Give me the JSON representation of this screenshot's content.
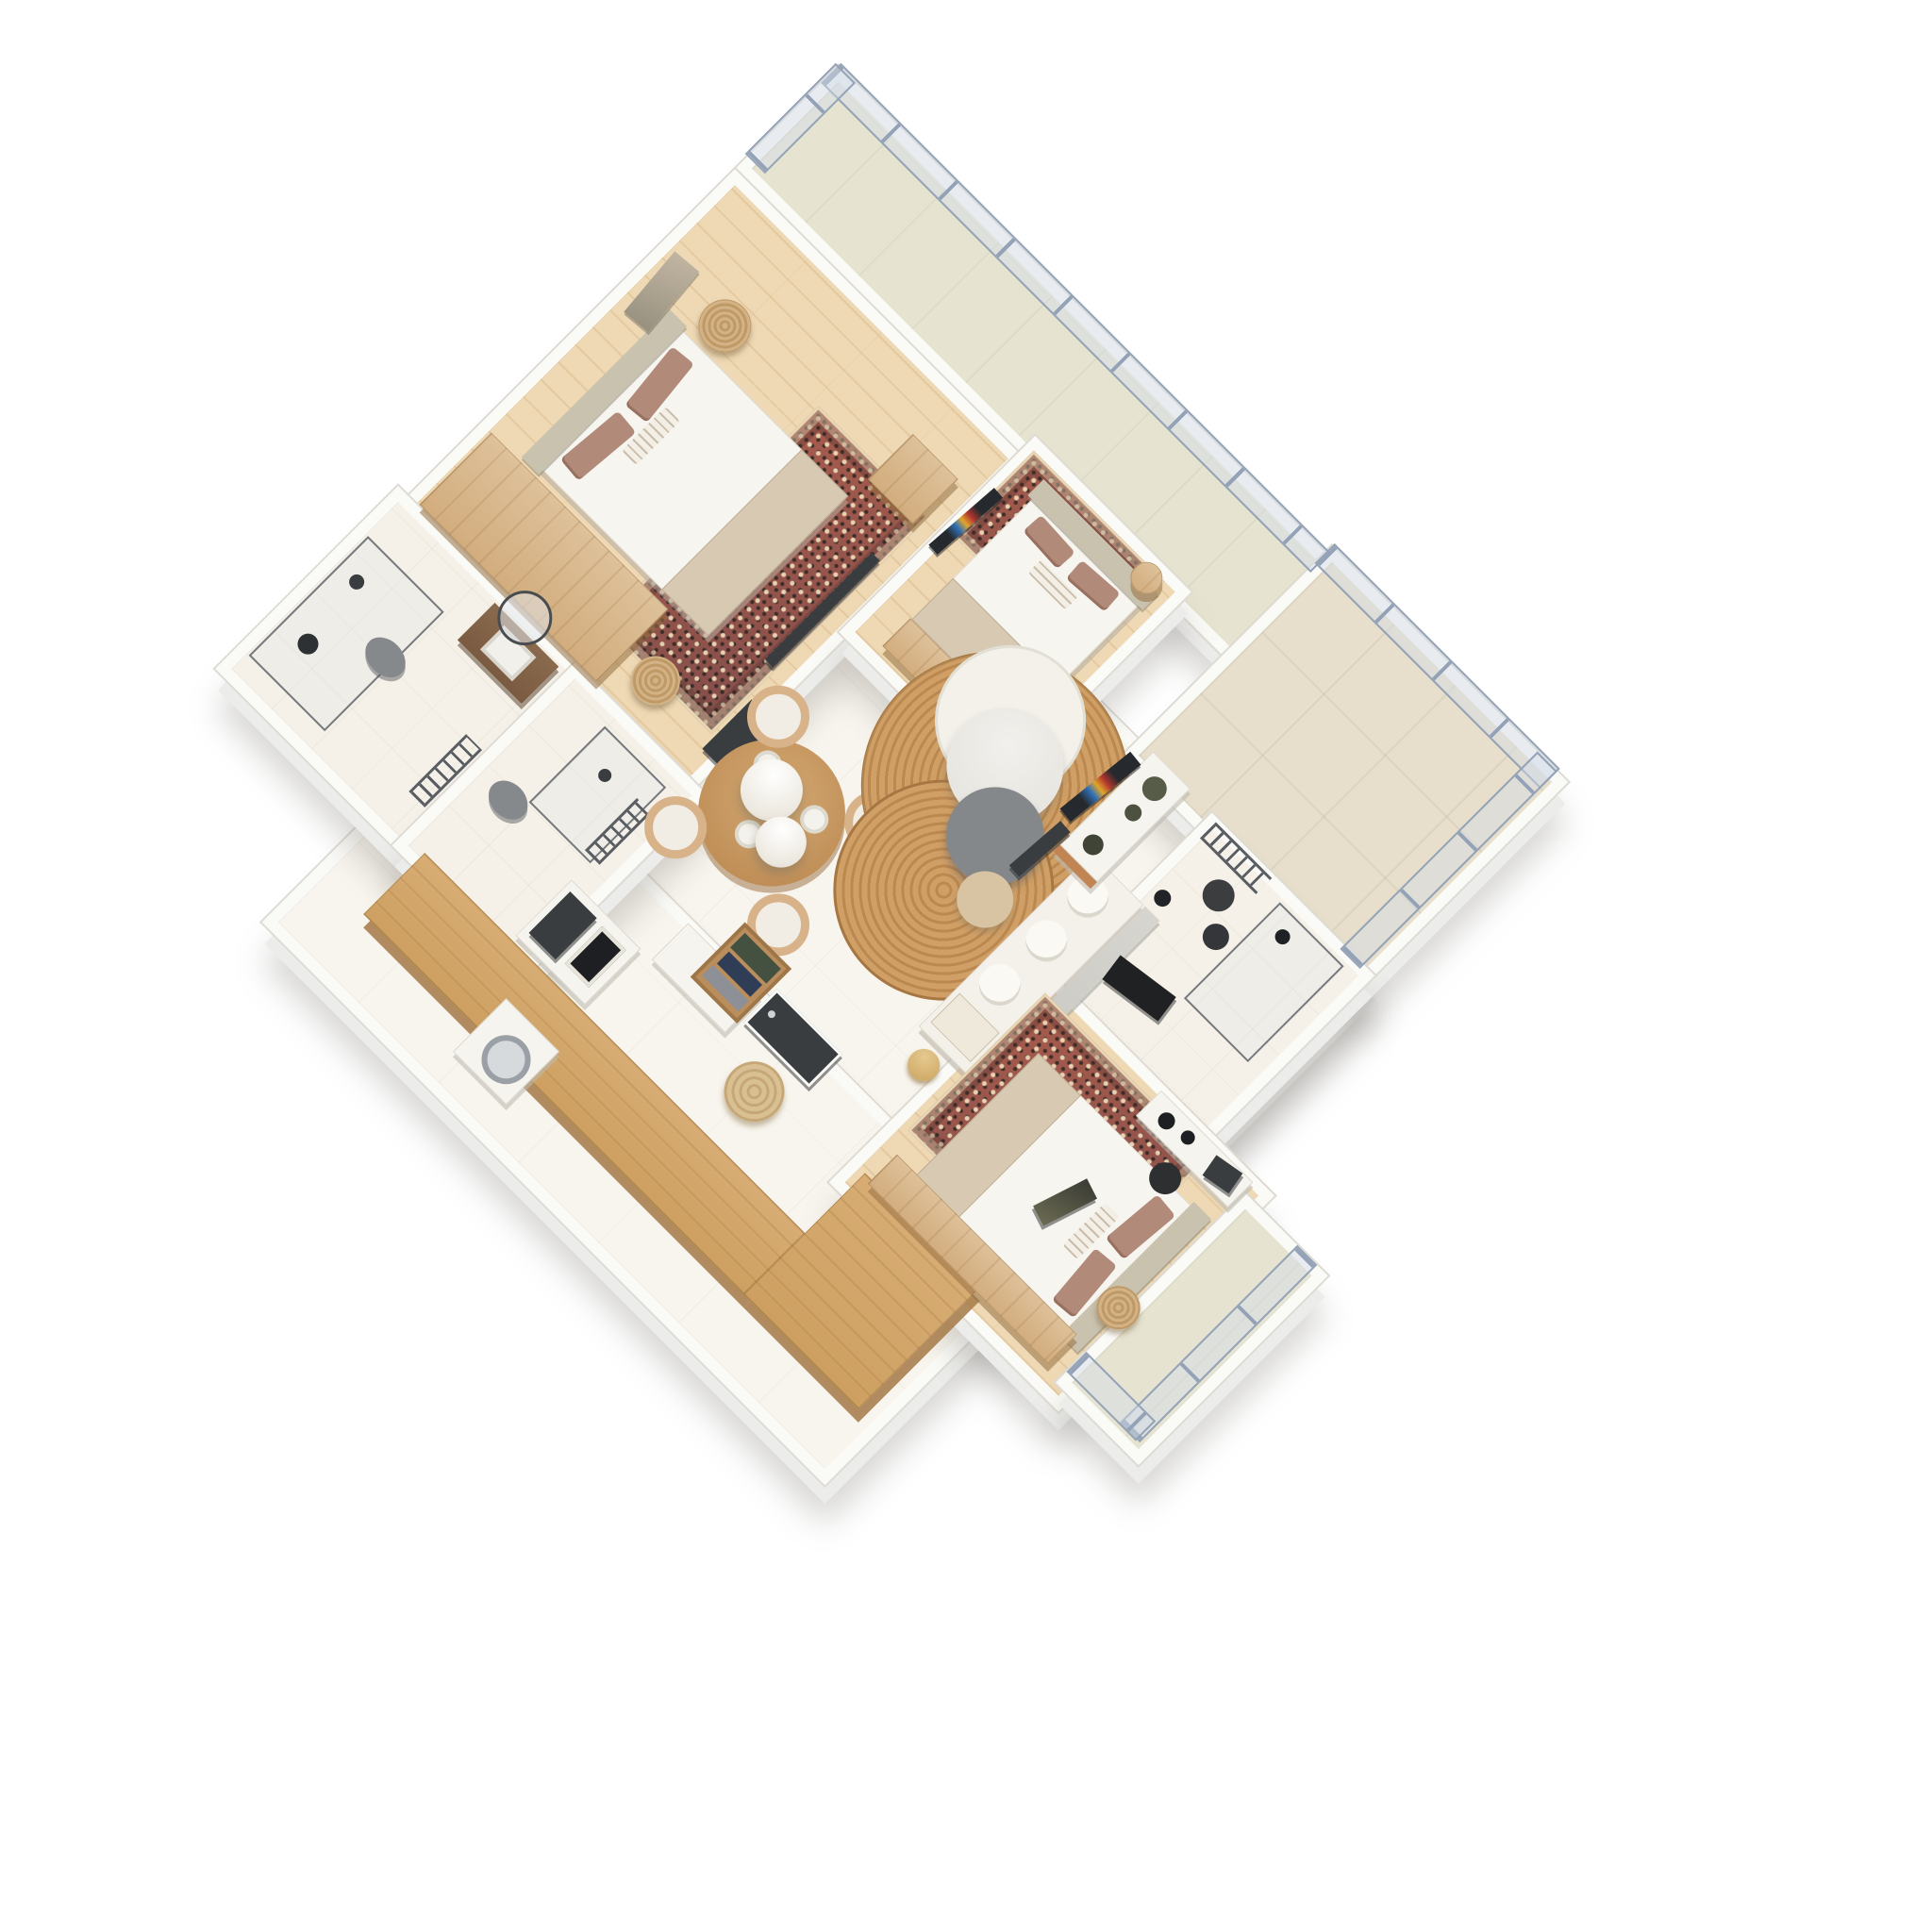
{
  "scene": {
    "type": "isometric-3d-floor-plan-render",
    "view": "top-down rotated 45 degrees",
    "background": "#ffffff",
    "visible_text": "none"
  },
  "palette": {
    "wall": "#fafaf7",
    "wall_edge": "#dedbd4",
    "wood_floor": "#eed9b4",
    "cream_tile_floor": "#f8f5ee",
    "terrace_tile": "#e7decb",
    "balcony_tile": "#e6e3d1",
    "glass_railing": "#c6d0dd",
    "railing_frame": "#93a2b6",
    "counter_wood": "#d2a76f",
    "wardrobe_wood": "#dec19a",
    "ornate_rug_base": "#a05a4a",
    "ornate_rug_accent": "#e7d6b4",
    "jute_rug": "#cf9f66",
    "marble_table": "#edebe7",
    "gray_table": "#84888b",
    "beige_table": "#d8c3a3",
    "sofa": "#f4f1ea",
    "bed_linen": "#f7f5f0",
    "blanket": "#d8c9b2",
    "pillow_mauve": "#b18a79",
    "headboard": "#c9c2ae",
    "dark_fixture": "#3a3d40",
    "toilet_gray": "#85898c",
    "gold_lamp": "#c9a25e",
    "olive_vase": "#575c49",
    "book_green": "#445140",
    "book_navy": "#2f3d57",
    "rattan_pendant": "#d3b285"
  },
  "rooms": [
    {
      "id": 0,
      "name": "north balcony",
      "floor": "balcony tile",
      "furniture": [
        "glass railing",
        "railing posts"
      ]
    },
    {
      "id": 1,
      "name": "east terrace",
      "floor": "large beige tiles",
      "furniture": [
        "glass railing"
      ]
    },
    {
      "id": 2,
      "name": "bedroom 1",
      "floor": "light oak planks",
      "furniture": [
        "double bed",
        "headboard",
        "mauve pillows",
        "striped lumbar pillow",
        "beige blanket",
        "ornate rug",
        "wood wardrobe",
        "nightstand bench",
        "two rattan pendant lamps",
        "wall art",
        "wall tv"
      ]
    },
    {
      "id": 3,
      "name": "bedroom 2",
      "floor": "light oak planks",
      "furniture": [
        "double bed",
        "ornate rug",
        "wood dresser",
        "colorful wall art",
        "round side table"
      ]
    },
    {
      "id": 4,
      "name": "bathroom 1",
      "floor": "stone tile",
      "furniture": [
        "glass shower",
        "gray toilet",
        "walnut vanity with sink",
        "round mirror",
        "towel ladder radiator",
        "black wall lamp"
      ]
    },
    {
      "id": 5,
      "name": "shower room",
      "floor": "stone tile",
      "furniture": [
        "gray toilet",
        "glass shower panel",
        "towel ladder radiator",
        "shower arm"
      ]
    },
    {
      "id": 6,
      "name": "living and dining room",
      "floor": "cream tiles",
      "furniture": [
        "round dining table",
        "four curved chairs",
        "table plates",
        "two white sphere pendants",
        "dark tall cabinet",
        "jute oval rug",
        "white round rug",
        "marble coffee table",
        "gray round table",
        "beige side cylinder",
        "white sofa",
        "stone panel",
        "gold floor lamp",
        "tv console with olive vases",
        "leaning colorful artwork",
        "leaning dark artwork"
      ]
    },
    {
      "id": 7,
      "name": "kitchen",
      "floor": "cream tiles",
      "furniture": [
        "L-shaped oak counter",
        "dark oven block",
        "framed artwork",
        "washing machine",
        "white partition"
      ]
    },
    {
      "id": 8,
      "name": "bathroom 2",
      "floor": "stone tile",
      "furniture": [
        "glass shower",
        "black shower head",
        "two dark vessel sinks",
        "dark mirror",
        "towel ladder radiator",
        "black pendant lamps"
      ]
    },
    {
      "id": 9,
      "name": "bedroom 3",
      "floor": "light oak planks",
      "furniture": [
        "double bed",
        "mauve pillows",
        "beige blanket",
        "ornate rug",
        "wood wardrobe",
        "desk with two black lamps",
        "dark desk chair",
        "dark monitor",
        "leaning artwork",
        "rattan pendant lamp"
      ]
    },
    {
      "id": 10,
      "name": "bedroom 3 balcony",
      "floor": "beige tile",
      "furniture": [
        "glass railing"
      ]
    },
    {
      "id": 11,
      "name": "entry",
      "floor": "cream tiles",
      "furniture": [
        "dark front door",
        "book crate shelf",
        "round tan pouf"
      ]
    }
  ]
}
